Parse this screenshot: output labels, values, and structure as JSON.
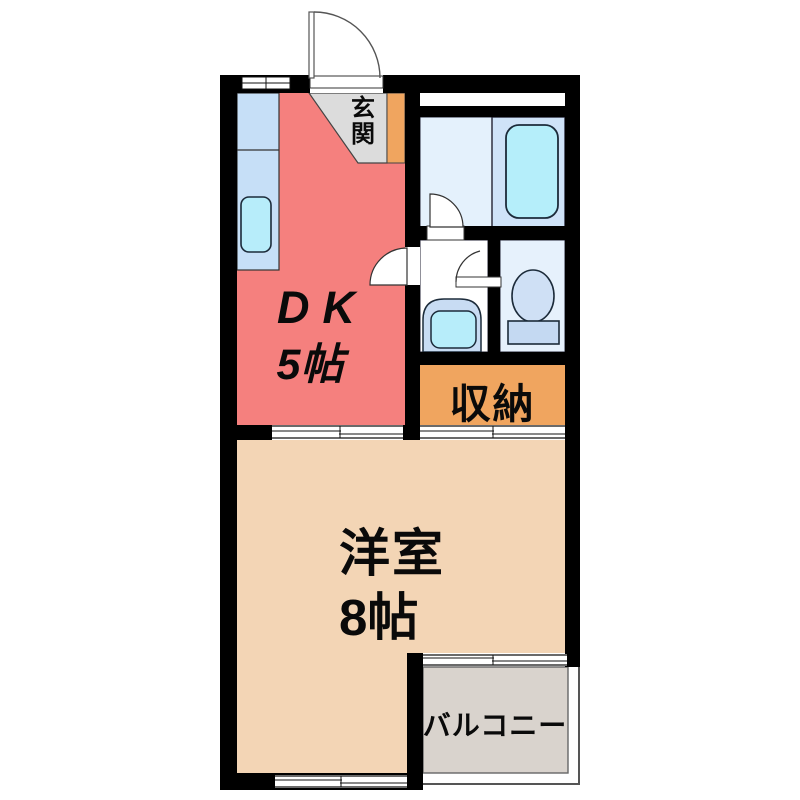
{
  "floor_plan": {
    "type": "japanese-apartment-floor-plan",
    "labels": {
      "entrance": "玄関",
      "dk_name": "DK",
      "dk_size": "5帖",
      "storage": "収納",
      "western_room_name": "洋室",
      "western_room_size": "8帖",
      "balcony": "バルコニー"
    },
    "rooms": [
      {
        "name": "entrance-genkan",
        "label": "玄関"
      },
      {
        "name": "dining-kitchen",
        "label": "DK 5帖"
      },
      {
        "name": "bathroom",
        "label": ""
      },
      {
        "name": "washroom",
        "label": ""
      },
      {
        "name": "toilet-room",
        "label": ""
      },
      {
        "name": "storage-closet",
        "label": "収納"
      },
      {
        "name": "western-room",
        "label": "洋室 8帖"
      },
      {
        "name": "balcony",
        "label": "バルコニー"
      }
    ],
    "fixtures": [
      "kitchen-counter",
      "kitchen-sink",
      "bathtub",
      "washbasin",
      "toilet",
      "shoe-cabinet"
    ],
    "door_symbols": [
      "entrance-swing-door",
      "bathroom-swing-door",
      "washroom-swing-door",
      "toilet-swing-door"
    ],
    "window_symbols": [
      "top-wall-window",
      "bathroom-window",
      "dk-room-sliding-partition",
      "closet-sliding-door",
      "bottom-wall-window",
      "balcony-window"
    ],
    "colors": {
      "wall": "#000000",
      "dk_floor": "#f5807e",
      "western_room_floor": "#f3d5b5",
      "balcony_floor": "#d9d3cd",
      "entrance_floor": "#dcdcdc",
      "storage_fill": "#f0a55f",
      "shoe_cabinet_fill": "#f0a55f",
      "kitchen_counter": "#c6dff7",
      "sink_cyan": "#b7edfa",
      "bathtub_cyan": "#b5eefa",
      "bathroom_left": "#e4f1fc",
      "bathroom_right": "#cfe3f8",
      "toilet_room": "#e6f1fc",
      "toilet_fixture": "#cfe0f5",
      "toilet_tank": "#c4d9f2",
      "washbasin_fill": "#c8dcf3",
      "label_text": "#0a0a0a"
    }
  }
}
